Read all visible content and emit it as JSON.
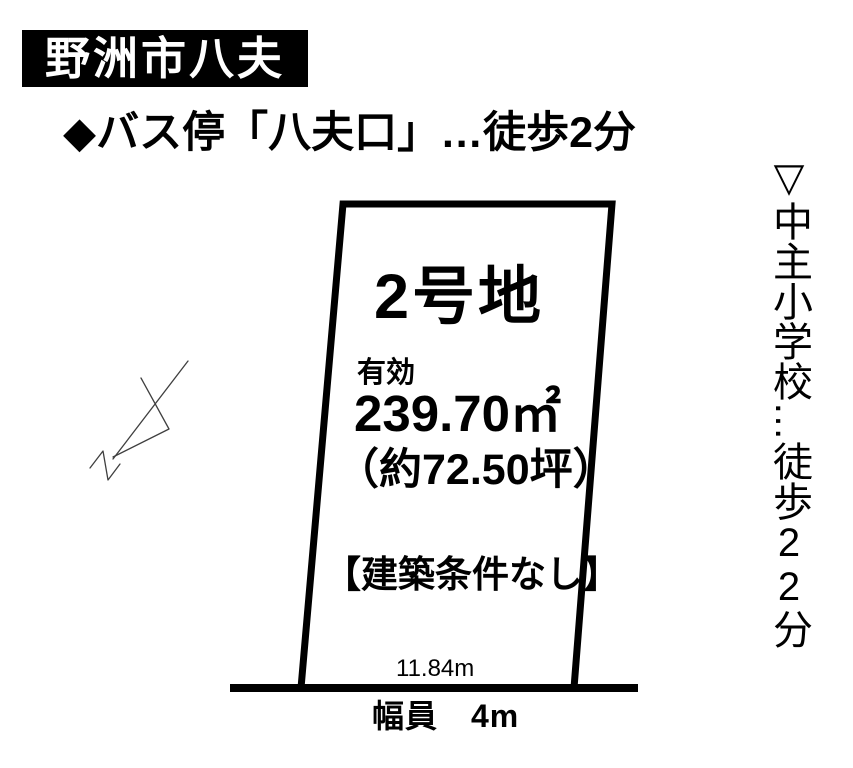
{
  "colors": {
    "ink": "#000000",
    "paper": "#ffffff",
    "sketch_line": "#3f3f3f"
  },
  "header": {
    "area_title": "野洲市八夫"
  },
  "access": {
    "bus_note": "◆バス停「八夫口」…徒歩2分"
  },
  "school_note": {
    "part1": "▽中主小学校",
    "ellipsis": "…",
    "part2": "徒歩22分"
  },
  "plot": {
    "name": "2号地",
    "area_label": "有効",
    "area_sqm": "239.70㎡",
    "area_tsubo": "（約72.50坪）",
    "condition": "【建築条件なし】",
    "frontage": "11.84m"
  },
  "road": {
    "width_label": "幅員　4m"
  },
  "icons": {
    "bus_bullet": "diamond-icon",
    "school_bullet": "triangle-down-icon",
    "sketch": "hand-drawn-arrow-sketch"
  }
}
